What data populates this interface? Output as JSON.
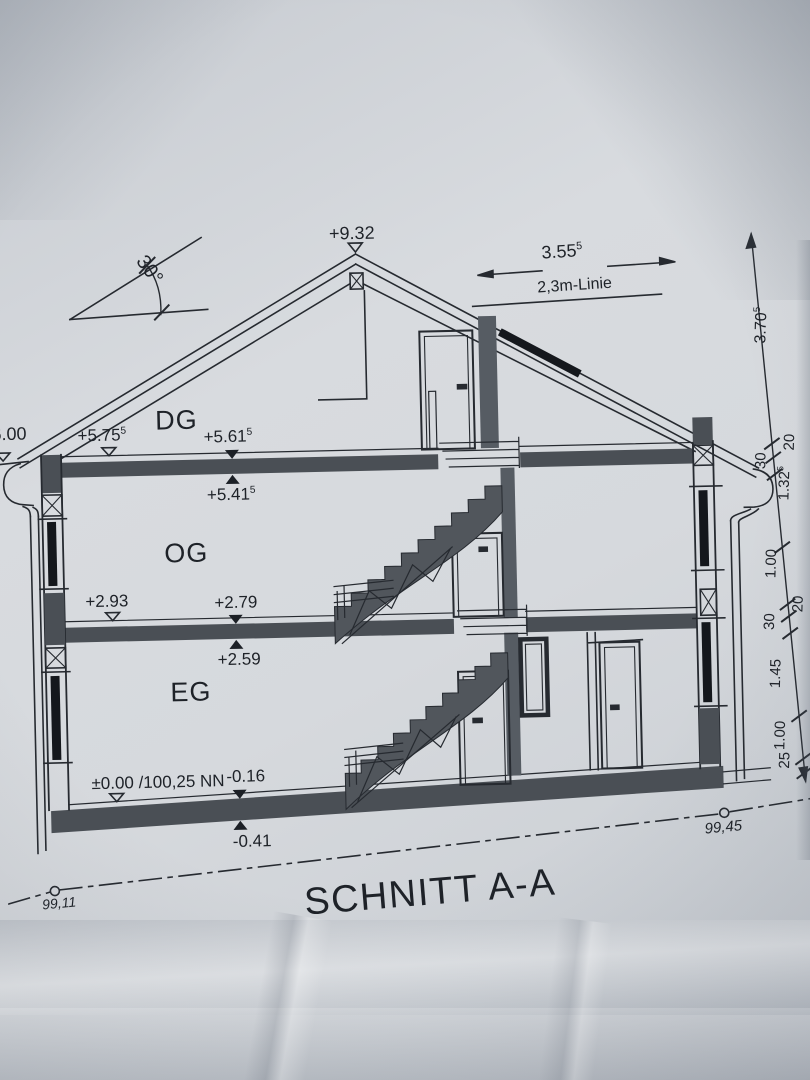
{
  "sheet": {
    "title": "SCHNITT A-A",
    "roof": {
      "ridge_level": "+9.32",
      "pitch_angle": "30°",
      "ridge_width": {
        "value": "3.55",
        "sup": "5"
      },
      "attic_height_line": "2,3m-Linie",
      "left_eave_level": "6.00"
    },
    "floors": {
      "dg": {
        "name": "DG",
        "finished_floor": {
          "value": "+5.75",
          "sup": "5"
        },
        "slab_top": {
          "value": "+5.61",
          "sup": "5"
        },
        "slab_bottom": {
          "value": "+5.41",
          "sup": "5"
        }
      },
      "og": {
        "name": "OG",
        "finished_floor": {
          "value": "+2.93",
          "sup": ""
        },
        "slab_top": {
          "value": "+2.79",
          "sup": ""
        },
        "slab_bottom": {
          "value": "+2.59",
          "sup": ""
        }
      },
      "eg": {
        "name": "EG",
        "finished_floor": {
          "value": "±0.00 /100,25 NN",
          "sup": ""
        },
        "slab_top": {
          "value": "-0.16",
          "sup": ""
        },
        "slab_bottom": {
          "value": "-0.41",
          "sup": ""
        }
      }
    },
    "dimension_chain": [
      {
        "value": "3.70",
        "sup": "5"
      },
      {
        "value": "20",
        "sup": ""
      },
      {
        "value": "30",
        "sup": ""
      },
      {
        "value": "1.32",
        "sup": "5"
      },
      {
        "value": "1.00",
        "sup": ""
      },
      {
        "value": "20",
        "sup": ""
      },
      {
        "value": "30",
        "sup": ""
      },
      {
        "value": "1.45",
        "sup": ""
      },
      {
        "value": "1.00",
        "sup": ""
      },
      {
        "value": "25",
        "sup": ""
      }
    ],
    "terrain": {
      "left_level": "99,11",
      "right_level": "99,45"
    },
    "colors": {
      "ink": "#262a30",
      "slab_fill": "#4a4f55",
      "glass": "#14171c",
      "paper": "#d6d9dd"
    }
  }
}
